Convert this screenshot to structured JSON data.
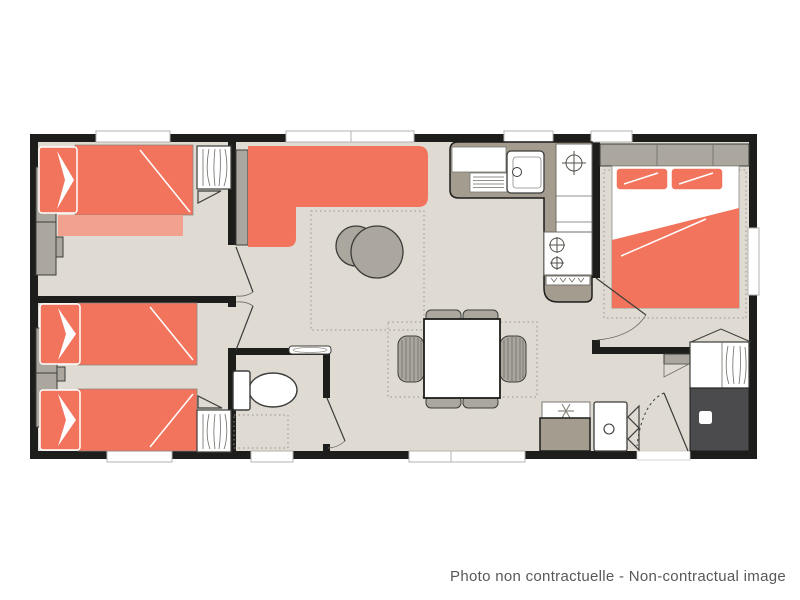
{
  "caption": "Photo non contractuelle - Non-contractual image",
  "colors": {
    "wall": "#1d1d1b",
    "floor": "#dfdbd3",
    "accent": "#f3745c",
    "accent_light": "#f2a18f",
    "furniture_gray": "#aba79e",
    "counter_taupe": "#a49d8f",
    "shower_dark": "#4b4b4d",
    "window_trim": "#b5b3af",
    "outline": "#3c3c3a",
    "caption_text": "#58585a"
  },
  "plan": {
    "type": "mobile-home-floor-plan",
    "rooms": [
      "bedroom-1",
      "bedroom-2",
      "wc",
      "living-room",
      "dining-area",
      "kitchen",
      "master-bedroom",
      "entrance-hall"
    ],
    "icons": [
      "snowflake-icon",
      "burner-icon",
      "ceiling-light-icon",
      "hanging-clothes-icon",
      "door-swing-icon"
    ]
  }
}
